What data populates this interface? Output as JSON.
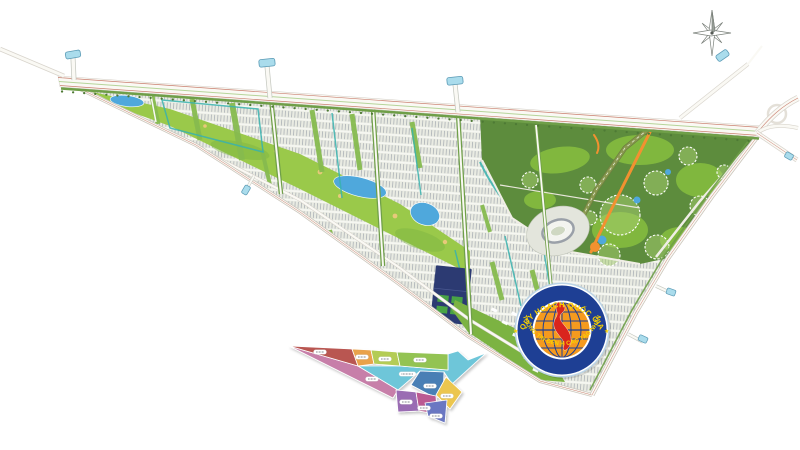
{
  "image": {
    "kind": "urban-master-plan-map",
    "background": "#ffffff"
  },
  "logo": {
    "arc_text_top": "QUY HOẠCH QUỐC GIA",
    "arc_text_bottom": "THÔNG TIN ĐẾN H CÁC TẠO NHÂN",
    "separator_glyph": "★"
  },
  "compass": {
    "glyph": "8-point-star"
  },
  "palette": {
    "fabric_bg": "#e9ebe2",
    "fabric_hatch": "#a9aeb4",
    "fabric_row": "#f6f7f2",
    "green_bright": "#8dc63f",
    "green_mid": "#7cb342",
    "green_strip": "#86bb4f",
    "green_dark_zone": "#5d8c3d",
    "green_verge": "#6f9f48",
    "tree": "#4e7a35",
    "golf": "#9ac94a",
    "lake": "#4fa8dc",
    "canal": "#38b2ae",
    "sand": "#e8c97a",
    "road_white": "#faf9f4",
    "road_casing": "#c9c4ba",
    "road_redline": "#c97f6f",
    "olive_road": "#8a9a50",
    "olive_road_dark": "#6f7f42",
    "orange_accent": "#f29130",
    "navy_parcel": "#2c3a72",
    "bridge_cap": "#aadcec",
    "bridge_cap_border": "#5a9ab5",
    "stadium_ring": "#9aa0a8",
    "stadium_fill": "#f3f4ef",
    "stadium_ground": "#e3e5dc",
    "logo_ring": "#1e3f94",
    "logo_halo": "#bcd4e6",
    "logo_globe": "#f59a1e",
    "logo_grid": "#1e3f94",
    "logo_vietnam": "#d9251d",
    "logo_text": "#f8d100",
    "compass": "#7a807a"
  },
  "inset": {
    "zones": [
      {
        "id": "zone-1",
        "color": "#b95651"
      },
      {
        "id": "zone-2",
        "color": "#e9a24b"
      },
      {
        "id": "zone-3",
        "color": "#b4cc55"
      },
      {
        "id": "zone-4",
        "color": "#93c353"
      },
      {
        "id": "zone-5",
        "color": "#6ec6d9"
      },
      {
        "id": "zone-6",
        "color": "#c77fa9"
      },
      {
        "id": "zone-7",
        "color": "#4a7fb5"
      },
      {
        "id": "zone-8",
        "color": "#ecc64f"
      },
      {
        "id": "zone-9",
        "color": "#9a6cb3"
      },
      {
        "id": "zone-10",
        "color": "#bb5a92"
      },
      {
        "id": "zone-11",
        "color": "#6b77c2"
      }
    ]
  }
}
